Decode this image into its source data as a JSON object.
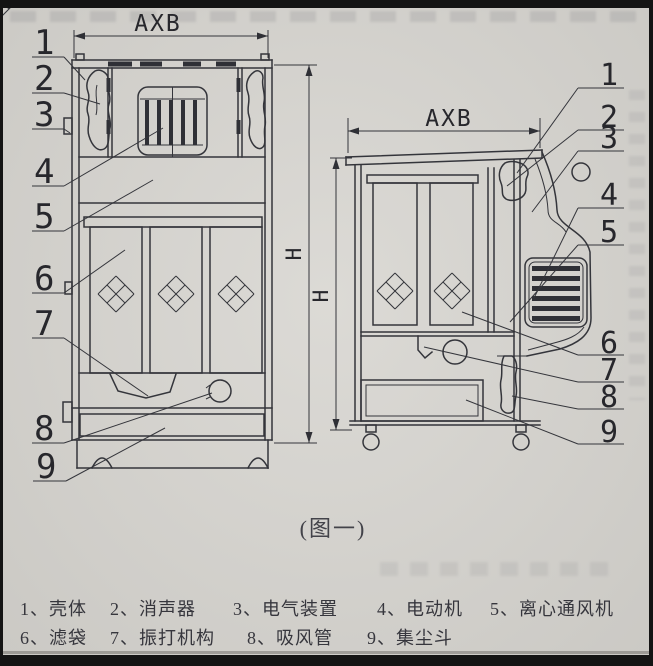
{
  "figure": {
    "caption": "(图一)",
    "dim_width_label": "AXB",
    "dim_height_label": "H",
    "front_view_callouts": [
      "1",
      "2",
      "3",
      "4",
      "5",
      "6",
      "7",
      "8",
      "9"
    ],
    "side_view_callouts": [
      "1",
      "2",
      "3",
      "4",
      "5",
      "6",
      "7",
      "8",
      "9"
    ]
  },
  "legend": {
    "items": [
      "1、壳体",
      "2、消声器",
      "3、电气装置",
      "4、电动机",
      "5、离心通风机",
      "6、滤袋",
      "7、振打机构",
      "8、吸风管",
      "9、集尘斗"
    ]
  },
  "colors": {
    "paper": "#d8d6d1",
    "ink": "#34353b",
    "border": "#141414"
  }
}
